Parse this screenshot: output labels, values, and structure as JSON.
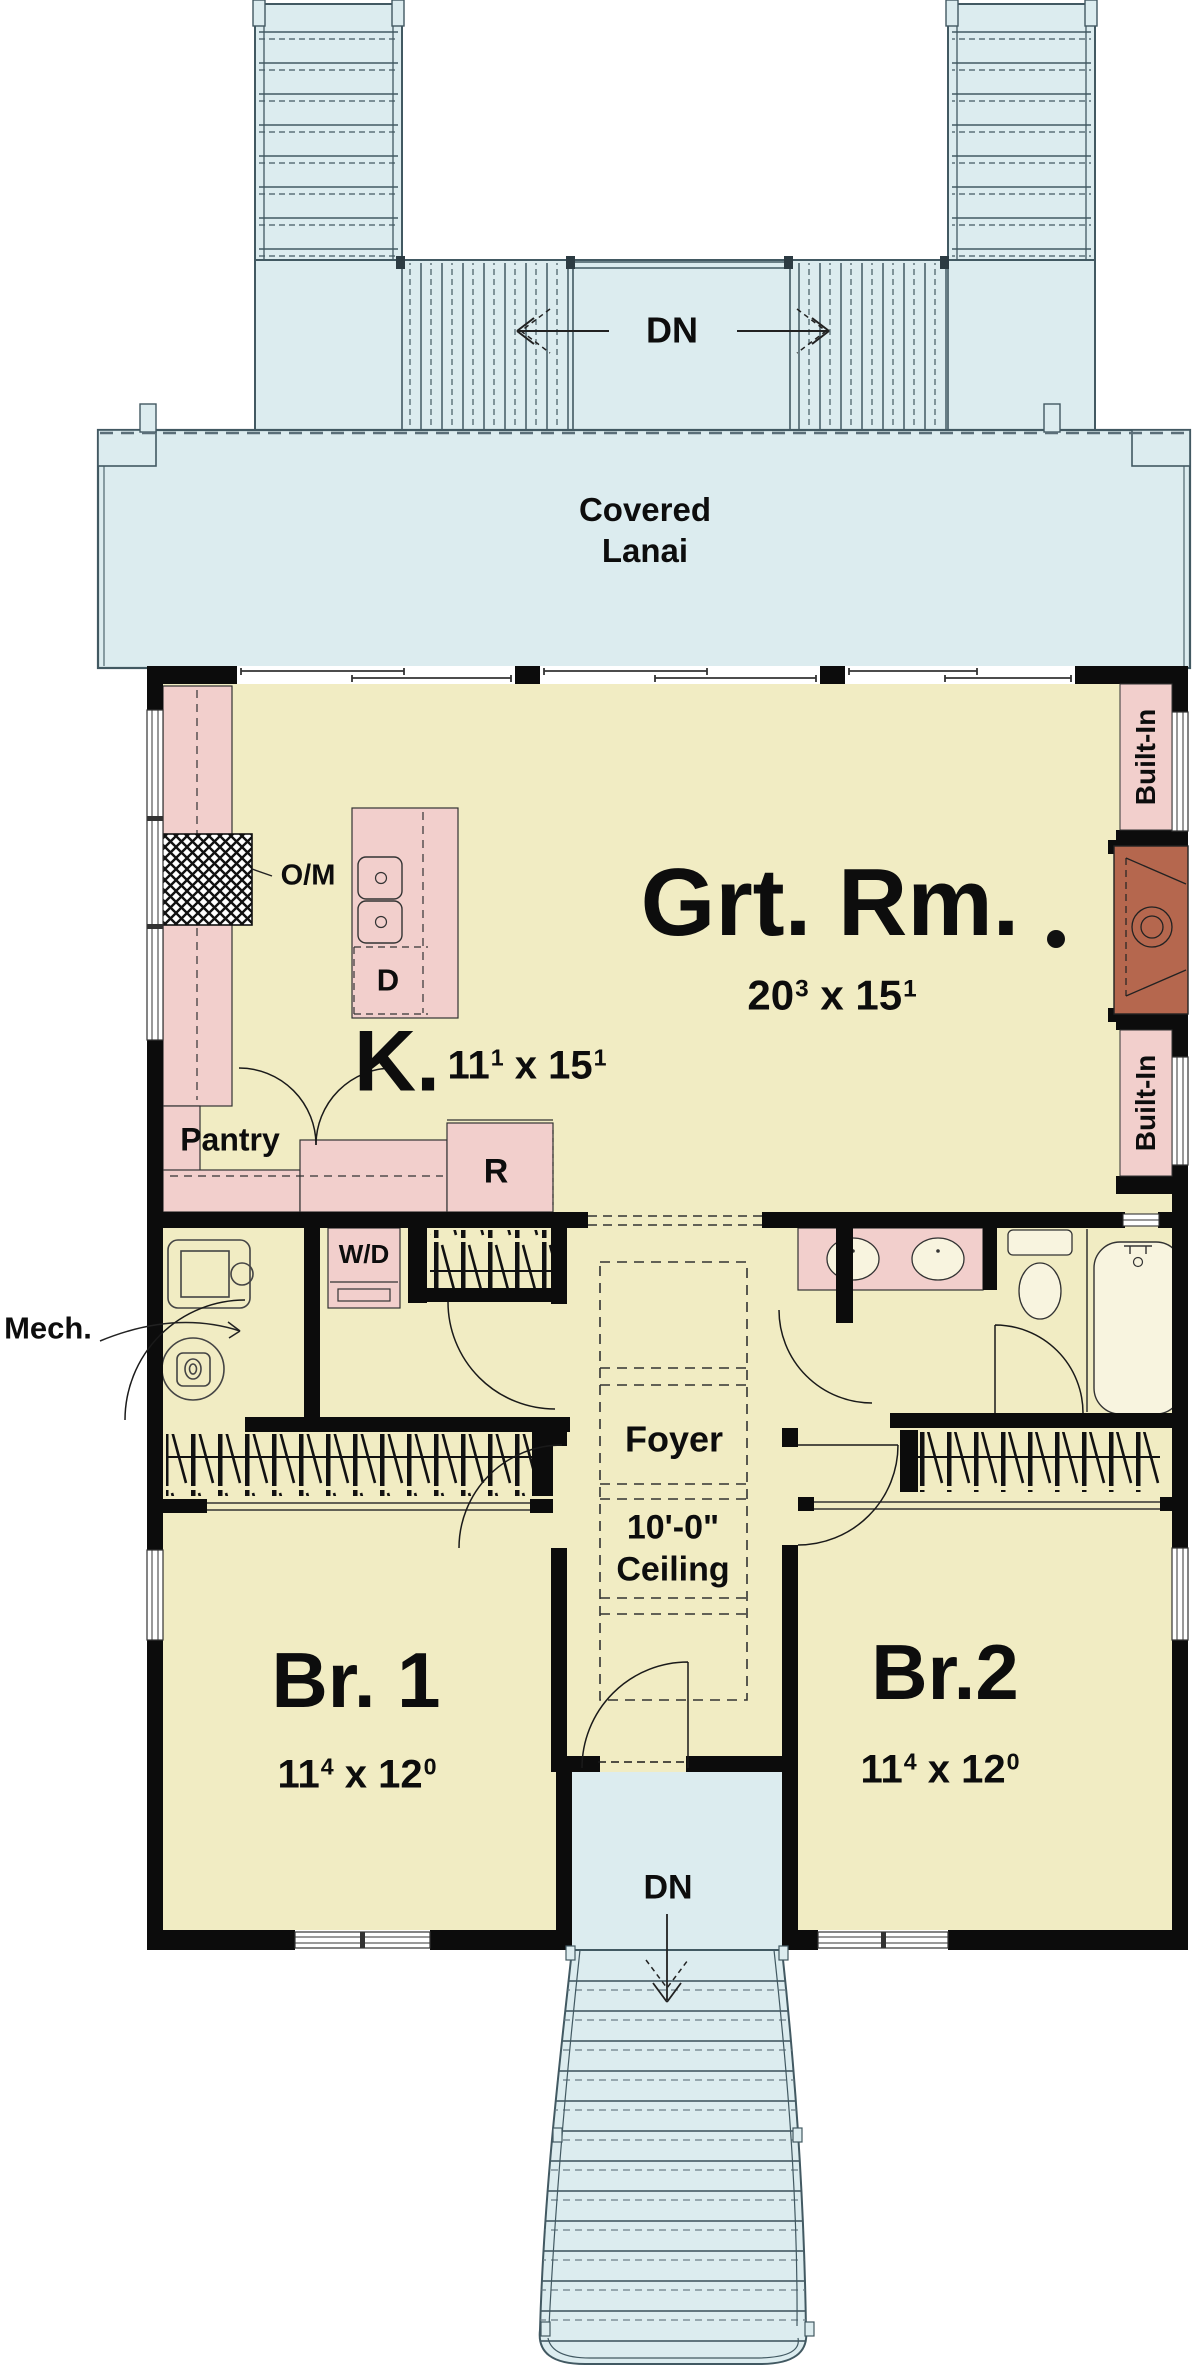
{
  "colors": {
    "floor": "#f1ecc3",
    "porch": "#dcecef",
    "cabinet": "#f2cfcc",
    "fireplace": "#b5674e",
    "wall": "#0c0c0c",
    "line": "#425962",
    "text": "#0d0d0d"
  },
  "stairs_top": {
    "dn": "DN"
  },
  "lanai": {
    "line1": "Covered",
    "line2": "Lanai"
  },
  "great_room": {
    "name": "Grt. Rm.",
    "dim": {
      "w": "20",
      "w_sup": "3",
      "sep": "x",
      "h": "15",
      "h_sup": "1"
    }
  },
  "kitchen": {
    "name": "K.",
    "dim": {
      "w": "11",
      "w_sup": "1",
      "sep": "x",
      "h": "15",
      "h_sup": "1"
    },
    "pantry": "Pantry",
    "oven_microwave": "O/M",
    "dishwasher": "D",
    "refrigerator": "R"
  },
  "utility": {
    "washer_dryer": "W/D",
    "mechanical": "Mech."
  },
  "built_ins": {
    "top": "Built-In",
    "bottom": "Built-In"
  },
  "foyer": {
    "name": "Foyer",
    "ceiling_height": "10'-0\"",
    "ceiling_word": "Ceiling"
  },
  "bedroom1": {
    "name": "Br. 1",
    "dim": {
      "w": "11",
      "w_sup": "4",
      "sep": "x",
      "h": "12",
      "h_sup": "0"
    }
  },
  "bedroom2": {
    "name": "Br.2",
    "dim": {
      "w": "11",
      "w_sup": "4",
      "sep": "x",
      "h": "12",
      "h_sup": "0"
    }
  },
  "entry": {
    "dn": "DN"
  }
}
